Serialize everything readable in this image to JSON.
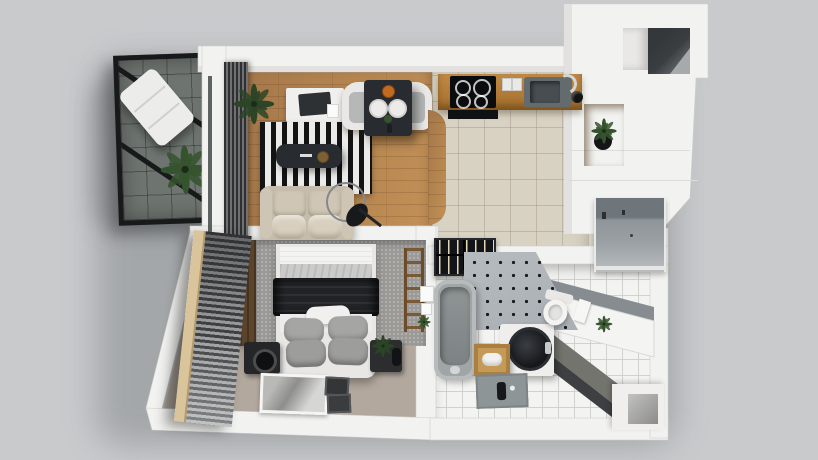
{
  "meta": {
    "scene": "apartment-3d-floorplan-top-view",
    "style": "photorealistic cutaway 3D render, no text labels visible"
  },
  "palette": {
    "bg": "#c8cacc",
    "wall": "#f2f2f0",
    "wall_edge": "#e2e1df",
    "frame_black": "#17191b",
    "balcony_floor": "#6e746f",
    "wood_floor": "#b5854f",
    "kitchen_floor": "#d8d2c3",
    "bedroom_floor": "#b2a89e",
    "bath_floor": "#f3f3f1",
    "rug_dark": "#141414",
    "rug_light": "#ebebe9",
    "sofa": "#c6bcab",
    "sofa_cushion": "#d8cfbe",
    "table_dark": "#282b2f",
    "bench_white": "#e9e8e6",
    "bench_cushion": "#b5b8b7",
    "counter_wood": "#b07a36",
    "hob_black": "#0b0c0d",
    "sink_gray": "#646b6f",
    "steel": "#d3d6d7",
    "niche_wood": "#bb8a44",
    "opening_dark": "#3a3e41",
    "door_gray": "#9ba0a4",
    "headboard_gray": "#9b9a97",
    "mattress_white": "#f3f3f1",
    "blanket_dark": "#212327",
    "pillow_gray": "#a5a5a3",
    "speaker_dark": "#242628",
    "blind_slat": "#3f4143",
    "blind_lit": "#9fa1a3",
    "window_wood": "#d9c49c",
    "tub_gray": "#a0a5a5",
    "accent_tile": "#a9afb4",
    "accent_dot": "#171a1f",
    "wine_rack": "#131417",
    "bottle_glint": "#e6d7b4",
    "vanity_white": "#efeeec",
    "basin_dark": "#16181c",
    "wood_box": "#c59a56",
    "mat_gray": "#8e9596",
    "toilet_white": "#f4f3f1",
    "dark_counter_top": "#73746d",
    "dark_counter_front": "#3d3f42",
    "tile_wall": "#f4f4f2",
    "plant_green": "#35532e",
    "plant_dark": "#2c4527"
  },
  "rooms": [
    {
      "id": "balcony",
      "label": "Balcony",
      "items": [
        "steel-frame-railing",
        "diagonal-braces",
        "lounge-chair",
        "palm-plant",
        "tile-floor"
      ]
    },
    {
      "id": "living-room",
      "label": "Living room",
      "items": [
        "vertical-louver-blinds",
        "desk",
        "laptop",
        "corner-plant",
        "striped-rug",
        "coffee-table",
        "sofa",
        "arc-floor-lamp",
        "curved-dining-bench",
        "dining-table",
        "plates",
        "wood-floor"
      ]
    },
    {
      "id": "kitchen",
      "label": "Kitchen",
      "items": [
        "wood-counter",
        "induction-hob",
        "sink",
        "faucet",
        "outlets",
        "pepper-mill",
        "tile-floor"
      ]
    },
    {
      "id": "hallway",
      "label": "Hallway / entry",
      "items": [
        "white-wardrobe-tower",
        "dark-shaft-opening",
        "wood-niche",
        "potted-plant",
        "entry-door-panel"
      ]
    },
    {
      "id": "bedroom",
      "label": "Bedroom",
      "items": [
        "headboard-panel",
        "double-bed",
        "black-blanket",
        "gray-pillows",
        "speaker-nightstand",
        "planter",
        "decor-ladder",
        "picture-frames-on-floor",
        "window-blinds",
        "carpet-floor"
      ]
    },
    {
      "id": "bathroom",
      "label": "Bathroom",
      "items": [
        "wine-rack",
        "dotted-accent-wall",
        "bathtub",
        "round-basin-vanity",
        "wooden-stool-towel",
        "bath-mat",
        "wall-hung-toilet",
        "dark-counter-run",
        "white-tile-wall",
        "wall-plant",
        "corner-niche",
        "tile-floor"
      ]
    }
  ]
}
